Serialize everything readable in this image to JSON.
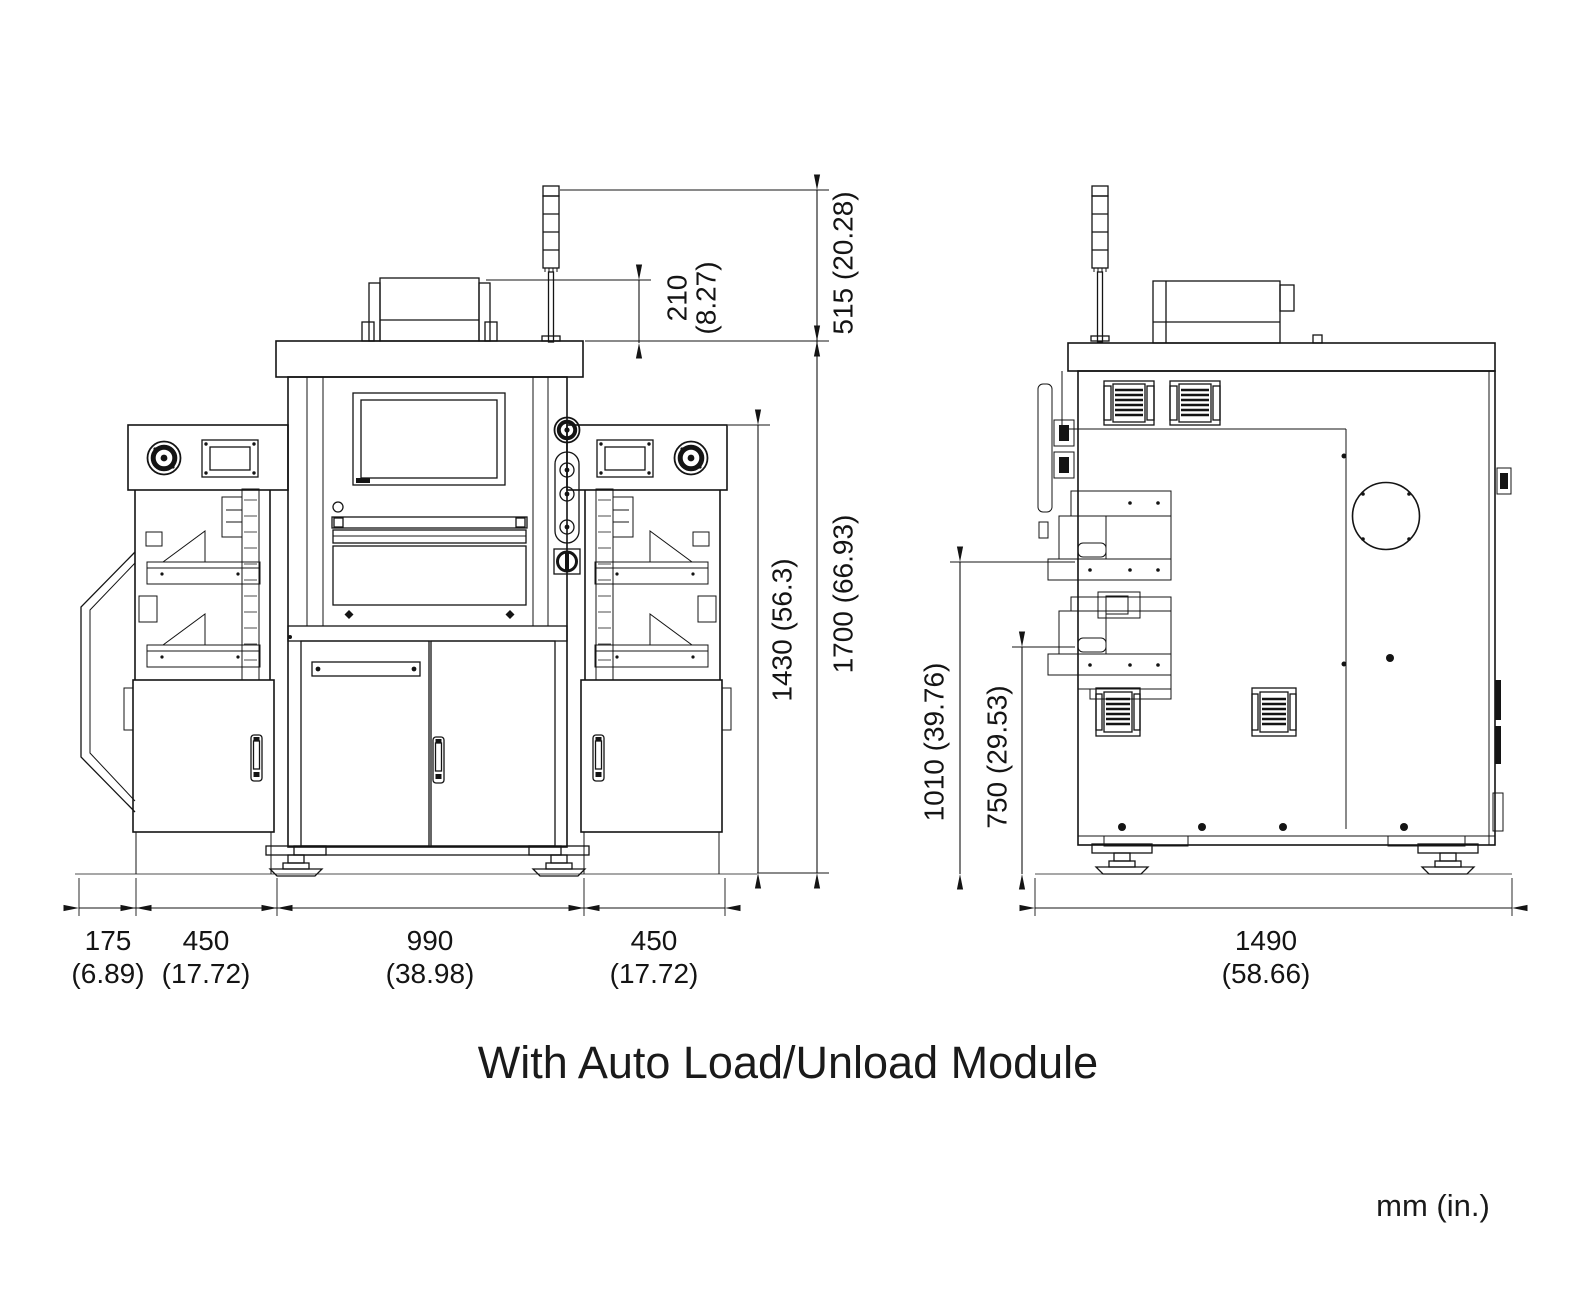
{
  "drawing": {
    "title": "With Auto Load/Unload Module",
    "units_note": "mm (in.)"
  },
  "front_view": {
    "dim_signal_tower_height": {
      "label": "515 (20.28)"
    },
    "dim_top_box_height": {
      "mm": "210",
      "in": "(8.27)"
    },
    "dim_side_module_height": {
      "label": "1430 (56.3)"
    },
    "dim_overall_height": {
      "label": "1700 (66.93)"
    },
    "dim_chute_width": {
      "mm": "175",
      "in": "(6.89)"
    },
    "dim_left_module_width": {
      "mm": "450",
      "in": "(17.72)"
    },
    "dim_main_body_width": {
      "mm": "990",
      "in": "(38.98)"
    },
    "dim_right_module_width": {
      "mm": "450",
      "in": "(17.72)"
    }
  },
  "side_view": {
    "dim_upper_magazine_height": {
      "label": "1010 (39.76)"
    },
    "dim_lower_magazine_height": {
      "label": "750 (29.53)"
    },
    "dim_overall_depth": {
      "mm": "1490",
      "in": "(58.66)"
    }
  }
}
